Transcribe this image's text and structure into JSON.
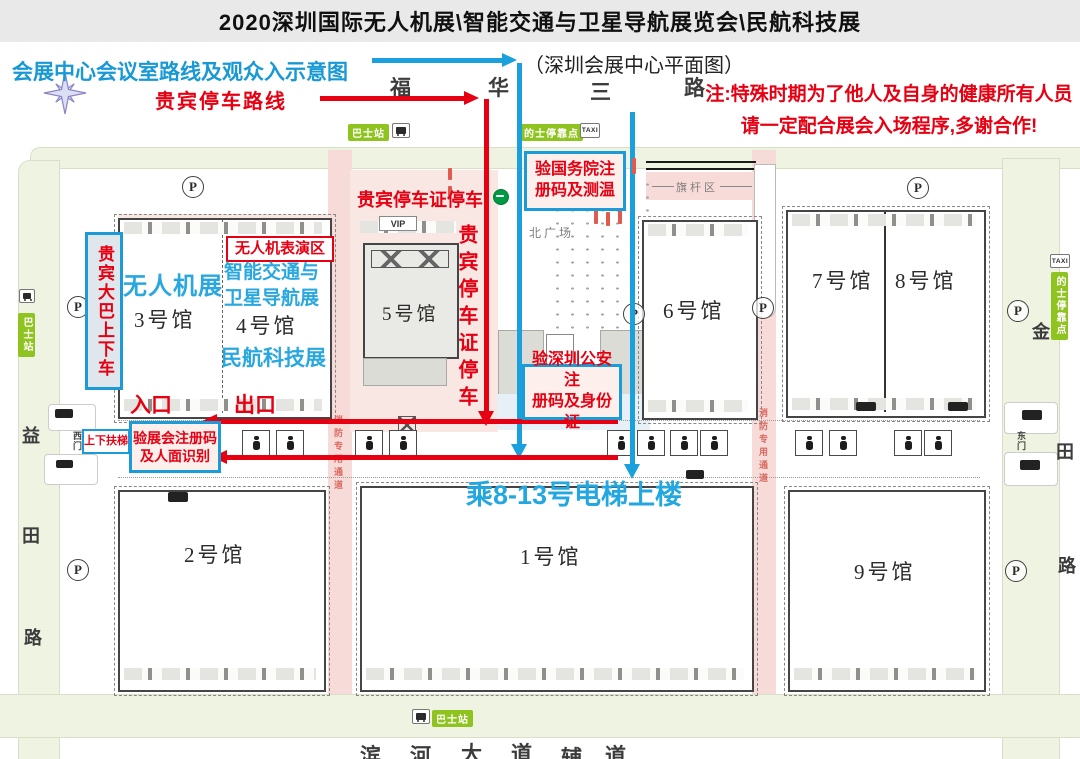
{
  "title": "2020深圳国际无人机展\\智能交通与卫星导航展览会\\民航科技展",
  "legend": {
    "route_blue_label": "会展中心会议室路线及观众入示意图",
    "map_subtitle": "（深圳会展中心平面图）",
    "route_red_label": "贵宾停车路线",
    "notice_line1": "注:特殊时期为了他人及自身的健康所有人员",
    "notice_line2": "请一定配合展会入场程序,多谢合作!"
  },
  "annotations": {
    "vip_parking_certificate": "贵宾停车证停车",
    "vip_bus_stop": "贵宾大巴上下车",
    "drone_show_area": "无人机表演区",
    "drone_expo": "无人机展",
    "its_expo_line1": "智能交通与",
    "its_expo_line2": "卫星导航展",
    "civil_aviation_expo": "民航科技展",
    "check_state_line1": "验国务院注",
    "check_state_line2": "册码及测温",
    "check_police_line1": "验深圳公安注",
    "check_police_line2": "册码及身份证",
    "check_expo_line1": "验展会注册码",
    "check_expo_line2": "及人面识别",
    "escalator": "上下扶梯",
    "entrance": "入口",
    "exit": "出口",
    "elevator_tip": "乘8-13号电梯上楼",
    "fire_lane": "消防专用通道"
  },
  "streets": {
    "top": [
      "福",
      "华",
      "三",
      "路"
    ],
    "left": [
      "益",
      "田",
      "路"
    ],
    "right": [
      "金",
      "田",
      "路"
    ],
    "bottom": [
      "滨",
      "河",
      "大",
      "道",
      "辅",
      "道"
    ]
  },
  "halls": {
    "h1": "1号馆",
    "h2": "2号馆",
    "h3": "3号馆",
    "h4": "4号馆",
    "h5": "5号馆",
    "h6": "6号馆",
    "h7": "7号馆",
    "h8": "8号馆",
    "h9": "9号馆"
  },
  "landmarks": {
    "north_plaza": "北广场",
    "flag_area": "旗杆区",
    "west_gate": "西门",
    "east_gate": "东门",
    "vip": "VIP",
    "parking": "P",
    "taxi": "TAXI",
    "bus_station": "巴士站",
    "taxi_stop": "的士停靠点"
  },
  "colors": {
    "route_blue": "#19a0dd",
    "route_red": "#e60012",
    "label_green": "#8fc31f",
    "corridor_pink": "#f7dbd9",
    "road_green": "#eff3e1"
  }
}
